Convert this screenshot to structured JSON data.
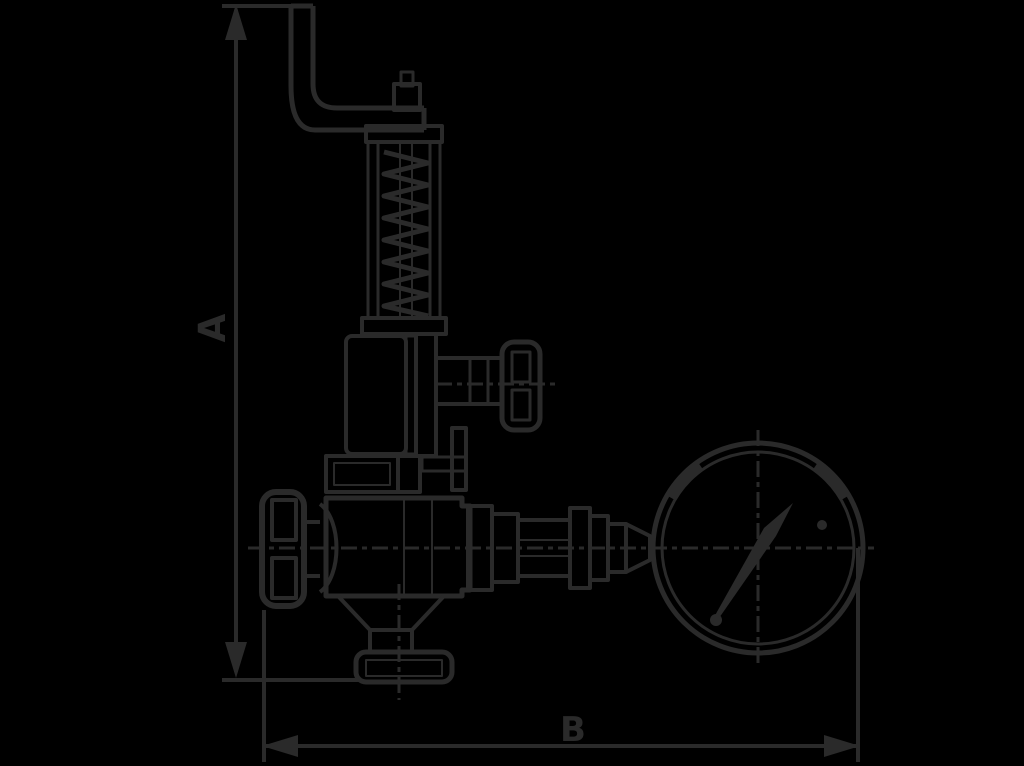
{
  "diagram": {
    "type": "valve-technical-drawing",
    "labels": {
      "dimension_a": "A",
      "dimension_b": "B"
    },
    "colors": {
      "background": "#000000",
      "line": "#2a2a2a"
    }
  }
}
